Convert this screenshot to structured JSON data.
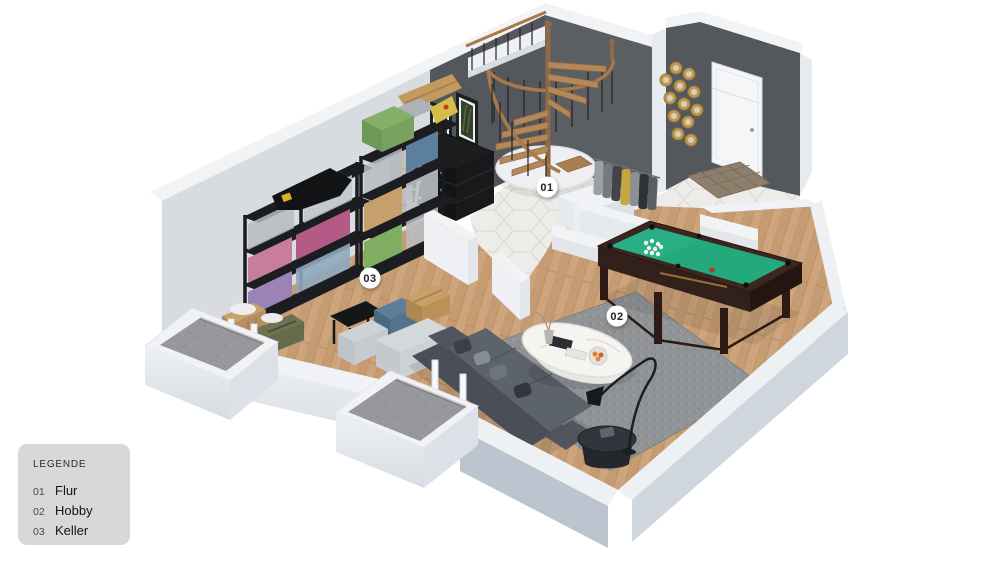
{
  "legend": {
    "title": "LEGENDE",
    "items": [
      {
        "num": "01",
        "label": "Flur"
      },
      {
        "num": "02",
        "label": "Hobby"
      },
      {
        "num": "03",
        "label": "Keller"
      }
    ]
  },
  "markers": [
    {
      "id": "01"
    },
    {
      "id": "02"
    },
    {
      "id": "03"
    }
  ],
  "colors": {
    "background": "#ffffff",
    "wall_dark": "#54575c",
    "wall_light": "#d8dbdf",
    "wall_top": "#f1f3f5",
    "wood_floor": "#cda57c",
    "tile_floor": "#edece8",
    "rug": "#8f9295",
    "pool_felt": "#23a97c",
    "sofa": "#565b62",
    "door": "#f5f6f8",
    "gold_decor": "#c09a4d",
    "concrete": "#96999c",
    "legend_bg": "#d8d8d8",
    "marker_bg": "#ffffff",
    "marker_text": "#222222"
  }
}
